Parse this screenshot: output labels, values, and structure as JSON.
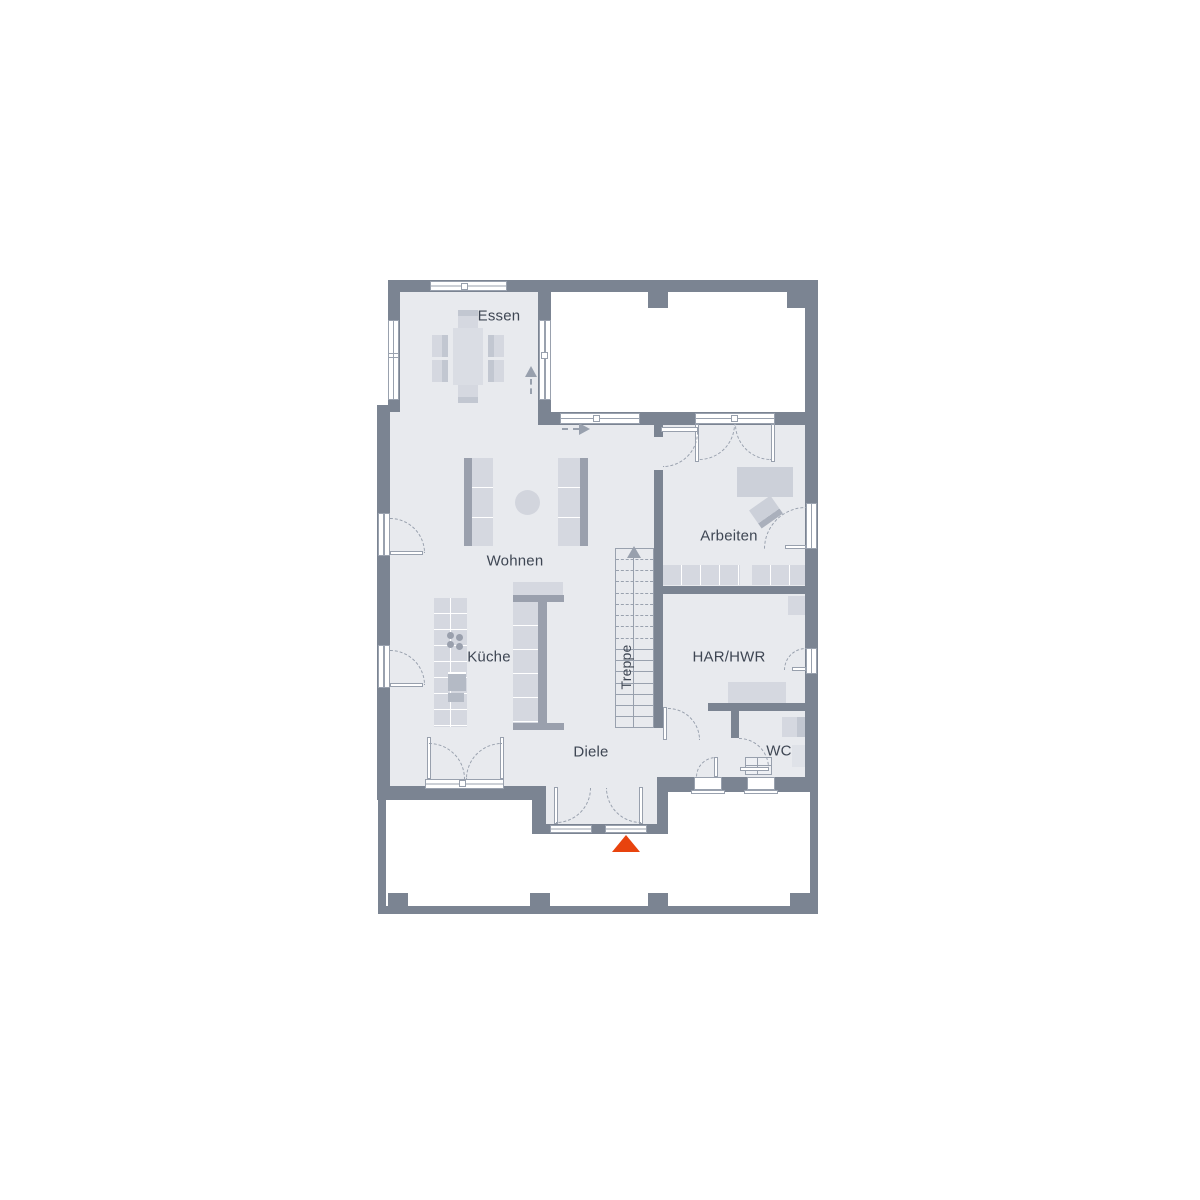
{
  "rooms": {
    "essen": {
      "label": "Essen"
    },
    "wohnen": {
      "label": "Wohnen"
    },
    "kueche": {
      "label": "Küche"
    },
    "arbeiten": {
      "label": "Arbeiten"
    },
    "har_hwr": {
      "label": "HAR/HWR"
    },
    "wc": {
      "label": "WC"
    },
    "diele": {
      "label": "Diele"
    },
    "treppe": {
      "label": "Treppe"
    }
  },
  "colors": {
    "wall": "#7b8492",
    "floor": "#e8eaee",
    "furnl": "#d5d8e0",
    "furnm": "#c2c7d1",
    "furnd": "#9aa0ad",
    "dash": "#98a0ad",
    "wline": "#99a1ae",
    "text": "#3e4653",
    "entrance": "#e8430e",
    "bg": "#ffffff"
  },
  "markers": {
    "entrance": {
      "shape": "triangle-up",
      "color": "#e8430e"
    }
  }
}
